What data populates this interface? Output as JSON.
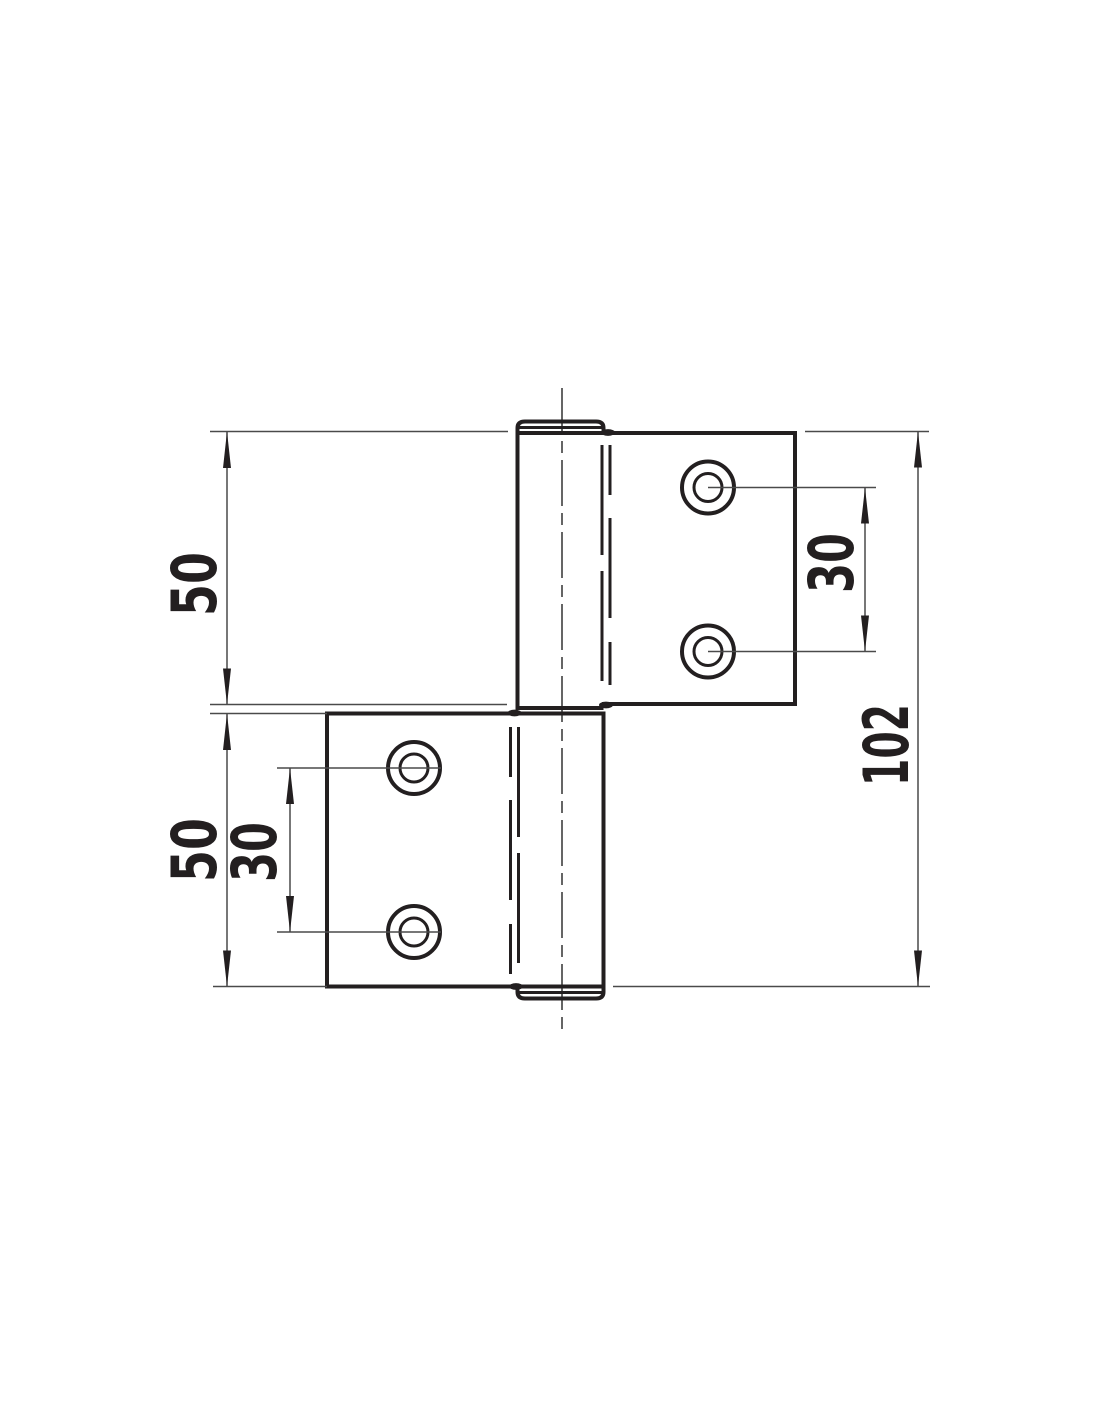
{
  "drawing": {
    "kind": "hinge-technical-drawing",
    "units_implied": "mm",
    "colors": {
      "outline": "#231f20",
      "thin_line": "#4a4a4a",
      "background": "#ffffff"
    },
    "dimensions": {
      "upper_leaf_height": "50",
      "lower_leaf_height": "50",
      "upper_hole_spacing": "30",
      "lower_hole_spacing": "30",
      "overall_height": "102"
    }
  }
}
